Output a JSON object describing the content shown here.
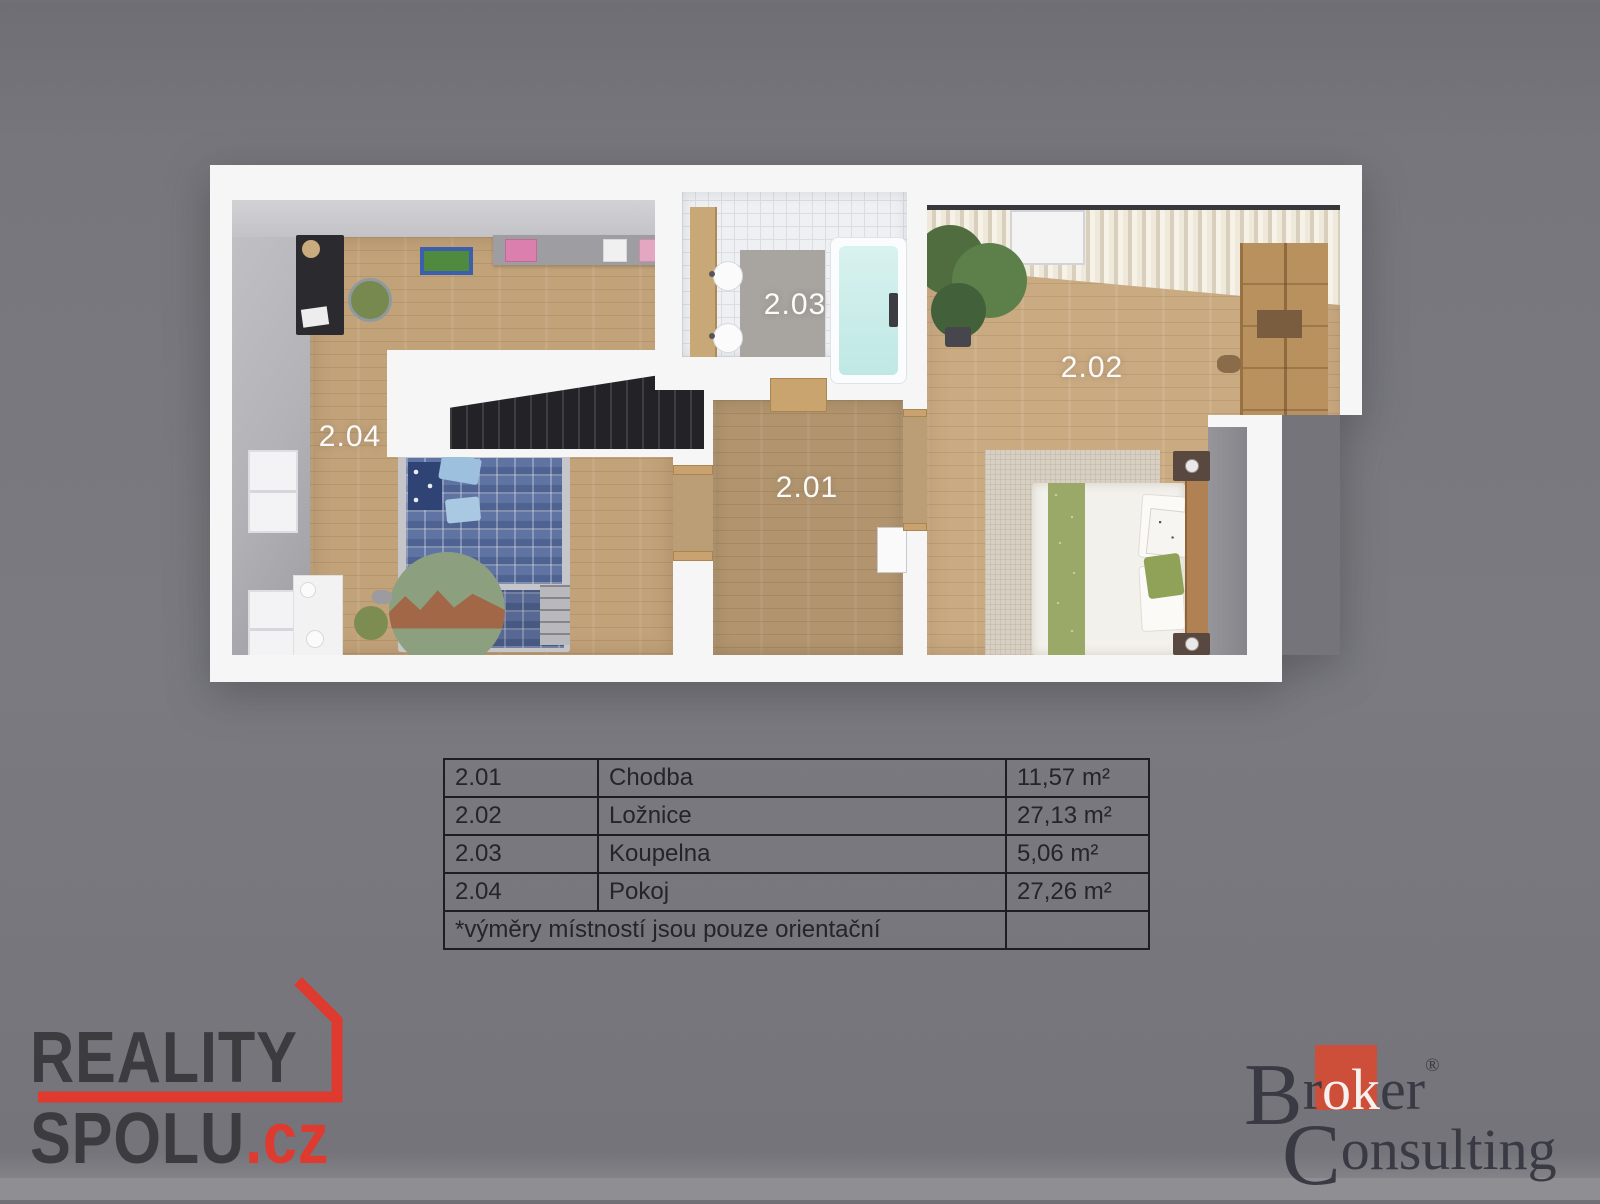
{
  "page": {
    "background": "#74747a",
    "bottom_strip": "#8e8e93"
  },
  "plan": {
    "labels": {
      "r201": "2.01",
      "r202": "2.02",
      "r203": "2.03",
      "r204": "2.04"
    },
    "label_color": "#ffffff",
    "accent_colors": {
      "floor_wood": "#c2a279",
      "bath_tile": "#eef0f3",
      "tub_water": "#c8ece9"
    }
  },
  "table": {
    "rows": [
      {
        "id": "2.01",
        "name": "Chodba",
        "area": "11,57 m²"
      },
      {
        "id": "2.02",
        "name": "Ložnice",
        "area": "27,13 m²"
      },
      {
        "id": "2.03",
        "name": "Koupelna",
        "area": "5,06 m²"
      },
      {
        "id": "2.04",
        "name": "Pokoj",
        "area": "27,26 m²"
      }
    ],
    "note": "*výměry místností jsou pouze orientační"
  },
  "logos": {
    "reality": {
      "line1": "REALITY",
      "line2": "SPOLU",
      "tld": ".cz",
      "accent": "#de3a2f",
      "text_color": "#3b3b40"
    },
    "broker": {
      "b": "B",
      "r": "r",
      "ok": "ok",
      "er": "er",
      "reg": "®",
      "c": "C",
      "onsulting": "onsulting",
      "accent": "#cd4f3a",
      "text_color": "#3a3a44"
    }
  }
}
